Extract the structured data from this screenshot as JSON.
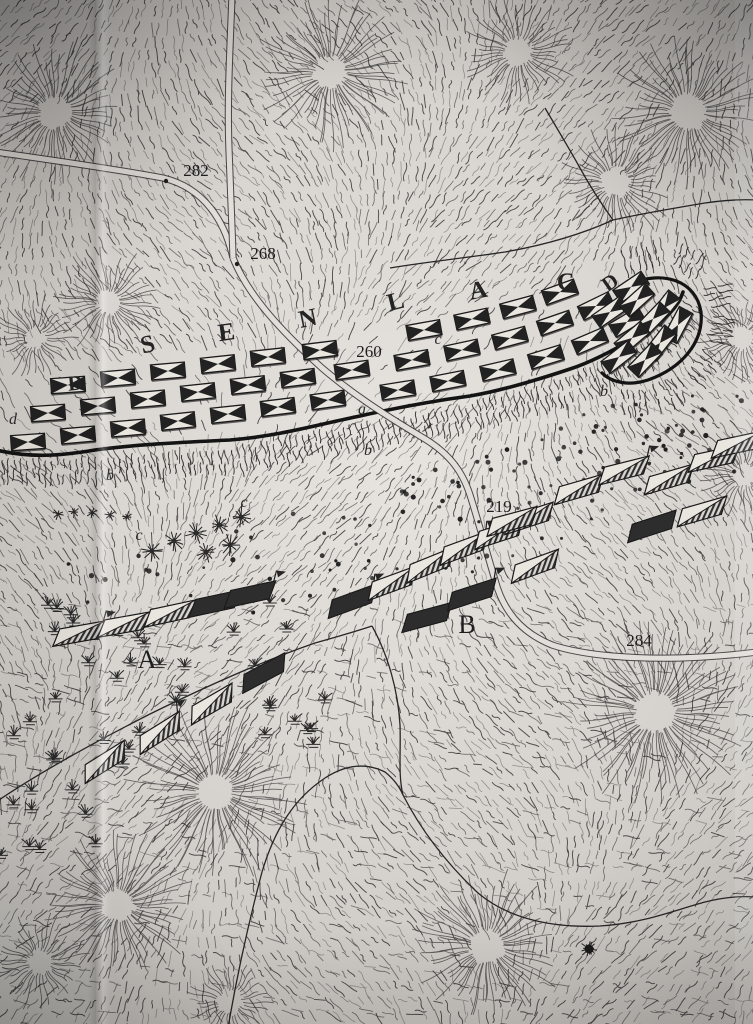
{
  "map": {
    "hill_name": {
      "text": "SENLAC",
      "letters": [
        {
          "ch": "S",
          "x": 150,
          "y": 352,
          "r": -14
        },
        {
          "ch": "E",
          "x": 228,
          "y": 340,
          "r": -8
        },
        {
          "ch": "N",
          "x": 310,
          "y": 326,
          "r": -12
        },
        {
          "ch": "L",
          "x": 398,
          "y": 309,
          "r": -14
        },
        {
          "ch": "A",
          "x": 480,
          "y": 298,
          "r": -10
        },
        {
          "ch": "C",
          "x": 567,
          "y": 290,
          "r": -4
        }
      ]
    },
    "flank_labels": [
      {
        "ch": "D",
        "x": 76,
        "y": 390,
        "r": -6
      },
      {
        "ch": "D",
        "x": 614,
        "y": 288,
        "r": -35
      }
    ],
    "spot_heights": [
      {
        "v": "282",
        "x": 196,
        "y": 176,
        "dot": [
          166,
          181
        ]
      },
      {
        "v": "268",
        "x": 263,
        "y": 259,
        "dot": [
          237,
          264
        ]
      },
      {
        "v": "260",
        "x": 369,
        "y": 357,
        "dot": null
      },
      {
        "v": "219",
        "x": 499,
        "y": 512,
        "dot": null
      },
      {
        "v": "284",
        "x": 639,
        "y": 646,
        "dot": null
      }
    ],
    "area_labels": [
      {
        "ch": "A",
        "x": 147,
        "y": 668
      },
      {
        "ch": "B",
        "x": 467,
        "y": 633
      }
    ],
    "minor_labels": [
      {
        "ch": "d",
        "x": 13,
        "y": 424
      },
      {
        "ch": "b",
        "x": 110,
        "y": 480
      },
      {
        "ch": "c",
        "x": 139,
        "y": 540
      },
      {
        "ch": "c",
        "x": 244,
        "y": 507
      },
      {
        "ch": "a",
        "x": 362,
        "y": 414
      },
      {
        "ch": "b",
        "x": 368,
        "y": 455
      },
      {
        "ch": "c",
        "x": 438,
        "y": 344
      },
      {
        "ch": "e",
        "x": 505,
        "y": 317
      },
      {
        "ch": "b",
        "x": 604,
        "y": 396
      }
    ],
    "english_units": [
      [
        28,
        442,
        -4
      ],
      [
        78,
        435,
        -5
      ],
      [
        128,
        428,
        -5
      ],
      [
        178,
        421,
        -6
      ],
      [
        228,
        414,
        -6
      ],
      [
        278,
        407,
        -7
      ],
      [
        328,
        400,
        -8
      ],
      [
        398,
        390,
        -9
      ],
      [
        448,
        381,
        -11
      ],
      [
        498,
        370,
        -13
      ],
      [
        546,
        357,
        -17
      ],
      [
        590,
        341,
        -23
      ],
      [
        48,
        413,
        -4
      ],
      [
        98,
        406,
        -5
      ],
      [
        148,
        399,
        -5
      ],
      [
        198,
        392,
        -6
      ],
      [
        248,
        385,
        -6
      ],
      [
        298,
        378,
        -7
      ],
      [
        352,
        370,
        -8
      ],
      [
        412,
        360,
        -10
      ],
      [
        462,
        350,
        -12
      ],
      [
        510,
        338,
        -15
      ],
      [
        555,
        323,
        -19
      ],
      [
        68,
        385,
        -4
      ],
      [
        118,
        378,
        -5
      ],
      [
        168,
        371,
        -5
      ],
      [
        218,
        364,
        -6
      ],
      [
        268,
        357,
        -6
      ],
      [
        320,
        350,
        -7
      ],
      [
        424,
        330,
        -10
      ],
      [
        472,
        319,
        -12
      ],
      [
        518,
        307,
        -15
      ],
      [
        560,
        292,
        -20
      ],
      [
        596,
        306,
        -26
      ],
      [
        631,
        287,
        -34
      ],
      [
        627,
        322,
        -31
      ],
      [
        610,
        312,
        -35
      ],
      [
        637,
        300,
        -42
      ],
      [
        664,
        308,
        -52
      ],
      [
        653,
        319,
        -46
      ],
      [
        678,
        325,
        -62
      ],
      [
        632,
        338,
        -40
      ],
      [
        660,
        343,
        -52
      ],
      [
        619,
        357,
        -38
      ],
      [
        645,
        360,
        -46
      ]
    ],
    "norman_units": [
      [
        77,
        634,
        -10,
        0,
        1
      ],
      [
        122,
        625,
        -10,
        0,
        0
      ],
      [
        168,
        614,
        -12,
        0,
        0
      ],
      [
        213,
        604,
        -12,
        1,
        0
      ],
      [
        248,
        595,
        -12,
        1,
        1
      ],
      [
        103,
        763,
        -32,
        0,
        0
      ],
      [
        158,
        734,
        -32,
        0,
        1
      ],
      [
        210,
        705,
        -30,
        0,
        0
      ],
      [
        262,
        674,
        -28,
        1,
        0
      ],
      [
        350,
        602,
        -20,
        1,
        1
      ],
      [
        390,
        584,
        -20,
        0,
        0
      ],
      [
        428,
        566,
        -22,
        0,
        0
      ],
      [
        462,
        549,
        -20,
        0,
        1
      ],
      [
        497,
        534,
        -18,
        0,
        0
      ],
      [
        527,
        519,
        -18,
        0,
        0
      ],
      [
        425,
        618,
        -15,
        1,
        0
      ],
      [
        470,
        595,
        -18,
        1,
        1
      ],
      [
        510,
        522,
        -15,
        0,
        0
      ],
      [
        533,
        567,
        -20,
        0,
        0
      ],
      [
        577,
        490,
        -16,
        0,
        0
      ],
      [
        622,
        471,
        -14,
        0,
        1
      ],
      [
        667,
        480,
        -16,
        0,
        0
      ],
      [
        712,
        459,
        -12,
        0,
        0
      ],
      [
        650,
        527,
        -18,
        1,
        0
      ],
      [
        700,
        512,
        -16,
        0,
        0
      ],
      [
        735,
        445,
        -12,
        0,
        0
      ]
    ],
    "features": {
      "palisade_front": "M -4 450 C 30 458 60 456 95 450 C 140 444 190 442 230 440 C 280 436 320 424 360 416 C 400 407 440 400 470 396 C 500 391 540 379 570 369 C 595 361 625 344 648 330 C 665 319 678 308 683 292",
      "palisade_hook": "M 630 284 C 662 270 696 280 701 312 C 704 342 682 368 648 380 C 630 386 612 383 602 373",
      "roads": [
        "M -4 152 C 50 160 110 168 163 178 C 205 188 225 222 233 258",
        "M 232 -4 C 230 50 227 100 229 150 C 231 195 232 225 233 258",
        "M 233 258 C 248 295 280 330 322 368 C 350 392 380 412 420 436 C 448 452 462 470 470 495 C 478 520 486 550 495 580 C 503 610 520 632 552 645 C 585 656 635 659 680 658 C 710 657 735 655 757 652"
      ],
      "streams": [
        "M 545 108 C 558 130 570 150 580 168 C 592 190 603 206 613 220",
        "M 613 220 C 580 235 545 245 505 252 C 465 258 425 262 390 268",
        "M 613 220 C 640 214 675 208 705 203 C 725 200 740 199 757 200",
        "M -4 802 C 40 772 95 742 150 714 C 205 687 260 662 315 643 C 340 636 360 630 372 626",
        "M 372 626 C 388 655 398 690 400 725 C 401 752 398 775 403 795",
        "M 228 1028 C 237 975 248 925 262 872 C 274 832 292 800 325 778 C 345 765 365 762 385 772 C 395 780 400 788 403 795",
        "M 403 795 C 420 828 445 862 478 893 C 510 920 555 928 600 926 C 645 923 675 910 705 902 C 725 897 740 896 757 897"
      ],
      "hills": [
        [
          55,
          112,
          14,
          72
        ],
        [
          330,
          72,
          14,
          78
        ],
        [
          518,
          52,
          12,
          58
        ],
        [
          688,
          112,
          16,
          78
        ],
        [
          108,
          302,
          10,
          55
        ],
        [
          615,
          182,
          12,
          58
        ],
        [
          35,
          338,
          8,
          42
        ],
        [
          655,
          712,
          18,
          95
        ],
        [
          215,
          792,
          16,
          92
        ],
        [
          118,
          905,
          14,
          78
        ],
        [
          487,
          946,
          15,
          78
        ],
        [
          40,
          962,
          10,
          48
        ],
        [
          742,
          338,
          10,
          50
        ],
        [
          744,
          475,
          10,
          46
        ],
        [
          230,
          1002,
          10,
          42
        ]
      ],
      "dot_bands": [
        {
          "cx": 565,
          "cy": 480,
          "w": 330,
          "h": 110,
          "rot": -20,
          "n": 85
        },
        {
          "cx": 330,
          "cy": 548,
          "w": 200,
          "h": 85,
          "rot": -15,
          "n": 26
        },
        {
          "cx": 140,
          "cy": 577,
          "w": 160,
          "h": 55,
          "rot": -10,
          "n": 10
        },
        {
          "cx": 680,
          "cy": 430,
          "w": 150,
          "h": 60,
          "rot": -18,
          "n": 18
        }
      ],
      "marsh_bands": [
        {
          "x": 6,
          "y": 598,
          "w": 320,
          "h": 170,
          "n": 40
        },
        {
          "x": 0,
          "y": 770,
          "w": 110,
          "h": 95,
          "n": 9
        }
      ],
      "trees": [
        [
          152,
          551
        ],
        [
          174,
          541
        ],
        [
          196,
          533
        ],
        [
          219,
          525
        ],
        [
          241,
          517
        ],
        [
          206,
          552
        ],
        [
          230,
          545
        ]
      ],
      "hedge": [
        [
          58,
          514
        ],
        [
          74,
          512
        ],
        [
          92,
          513
        ],
        [
          110,
          515
        ],
        [
          127,
          517
        ]
      ],
      "bush": [
        589,
        949
      ]
    },
    "ink_color": "#2b2b2b",
    "paper_color": "#e0ddd8"
  }
}
